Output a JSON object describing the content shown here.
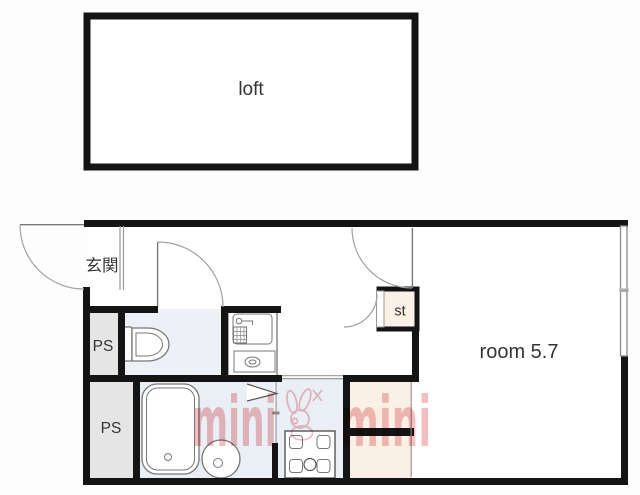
{
  "labels": {
    "loft": "loft",
    "genkan": "玄関",
    "ps_upper": "PS",
    "ps_lower": "PS",
    "storage": "st",
    "room": "room 5.7"
  },
  "watermark": {
    "brand_left": "mini",
    "brand_right": "mini",
    "mascot": "rabbit"
  },
  "colors": {
    "wall": "#141414",
    "line": "#999999",
    "fixture": "#777777",
    "text": "#333333",
    "wet_floor": "#eaeef5",
    "toilet_floor": "#edf1f6",
    "ps_fill": "#e5e5e5",
    "closet_fill": "#faf0e6",
    "st_fill": "#fbf0e5",
    "watermark": "#f0b3b5",
    "bg": "#fdfdfd"
  }
}
